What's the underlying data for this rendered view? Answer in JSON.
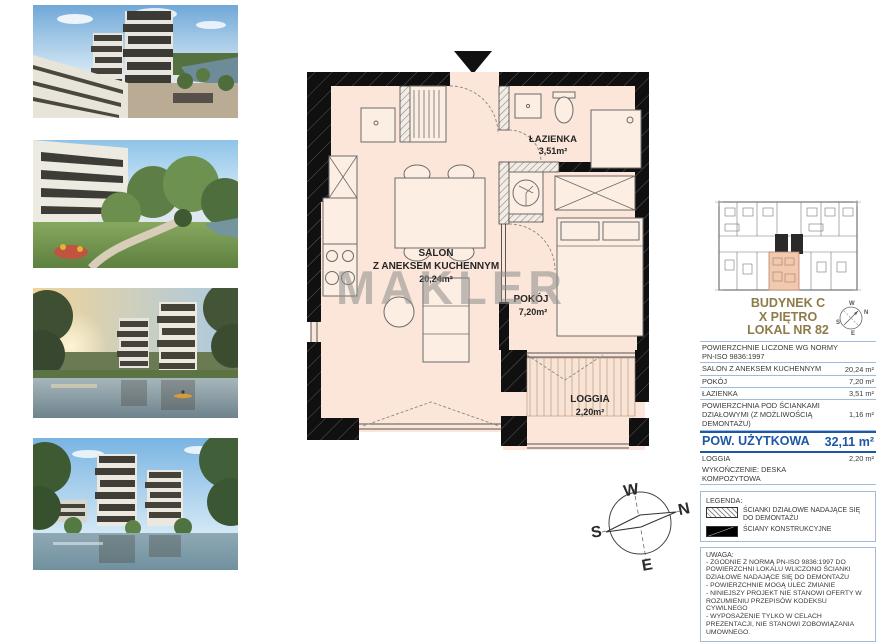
{
  "watermark": "MAKLER",
  "photos": [
    {
      "name": "render-aerial-buildings"
    },
    {
      "name": "render-garden-playground"
    },
    {
      "name": "render-river-sunset"
    },
    {
      "name": "render-pond-towers"
    }
  ],
  "plan": {
    "rooms": {
      "bathroom": {
        "name": "ŁAZIENKA",
        "area": "3,51m²"
      },
      "salon": {
        "name": "SALON",
        "name2": "Z ANEKSEM KUCHENNYM",
        "area": "20,24m²"
      },
      "bedroom": {
        "name": "POKÓJ",
        "area": "7,20m²"
      },
      "loggia": {
        "name": "LOGGIA",
        "area": "2,20m²"
      }
    }
  },
  "compass": {
    "w": "W",
    "n": "N",
    "s": "S",
    "e": "E"
  },
  "panel": {
    "building": "BUDYNEK C",
    "floor": "X PIĘTRO",
    "unit": "LOKAL NR 82",
    "table": {
      "header_line1": "POWIERZCHNIE LICZONE WG NORMY",
      "header_line2": "PN-ISO 9836:1997",
      "rows": [
        {
          "label": "SALON Z ANEKSEM KUCHENNYM",
          "value": "20,24 m²"
        },
        {
          "label": "POKÓJ",
          "value": "7,20 m²"
        },
        {
          "label": "ŁAZIENKA",
          "value": "3,51 m²"
        },
        {
          "label": "POWIERZCHNIA POD ŚCIANKAMI DZIAŁOWYMI (Z MOŻLIWOŚCIĄ DEMONTAŻU)",
          "value": "1,16 m²"
        }
      ],
      "total": {
        "label": "POW. UŻYTKOWA",
        "value": "32,11 m²"
      },
      "loggia_row": {
        "label": "LOGGIA",
        "value": "2,20 m²"
      },
      "finish_row": {
        "label": "WYKOŃCZENIE: DESKA KOMPOZYTOWA",
        "value": ""
      }
    },
    "legend": {
      "title": "LEGENDA:",
      "items": [
        {
          "swatch": "hatched",
          "label": "ŚCIANKI DZIAŁOWE NADAJĄCE SIĘ DO DEMONTAŻU"
        },
        {
          "swatch": "solid",
          "label": "ŚCIANY KONSTRUKCYJNE"
        }
      ]
    },
    "note": {
      "title": "UWAGA:",
      "lines": [
        "- ZGODNIE Z NORMĄ PN-ISO 9836:1997 DO POWIERZCHNI LOKALU WLICZONO ŚCIANKI DZIAŁOWE NADAJĄCE SIĘ DO DEMONTAŻU",
        "- POWIERZCHNIE MOGĄ ULEC ZMIANIE",
        "- NINIEJSZY PROJEKT NIE STANOWI OFERTY W ROZUMIENIU PRZEPISÓW KODEKSU CYWILNEGO",
        "- WYPOSAŻENIE TYLKO W CELACH PREZENTACJI, NIE STANOWI ZOBOWIĄZANIA UMOWNEGO."
      ]
    }
  },
  "colors": {
    "accent_gold": "#8d7b48",
    "accent_blue": "#1d57a5",
    "plan_fill": "#fbe6d9",
    "wall": "#101010",
    "table_border": "#9fbcd8",
    "watermark_gray": "#8c8c8c",
    "highlight_unit": "#f3c9ae"
  }
}
